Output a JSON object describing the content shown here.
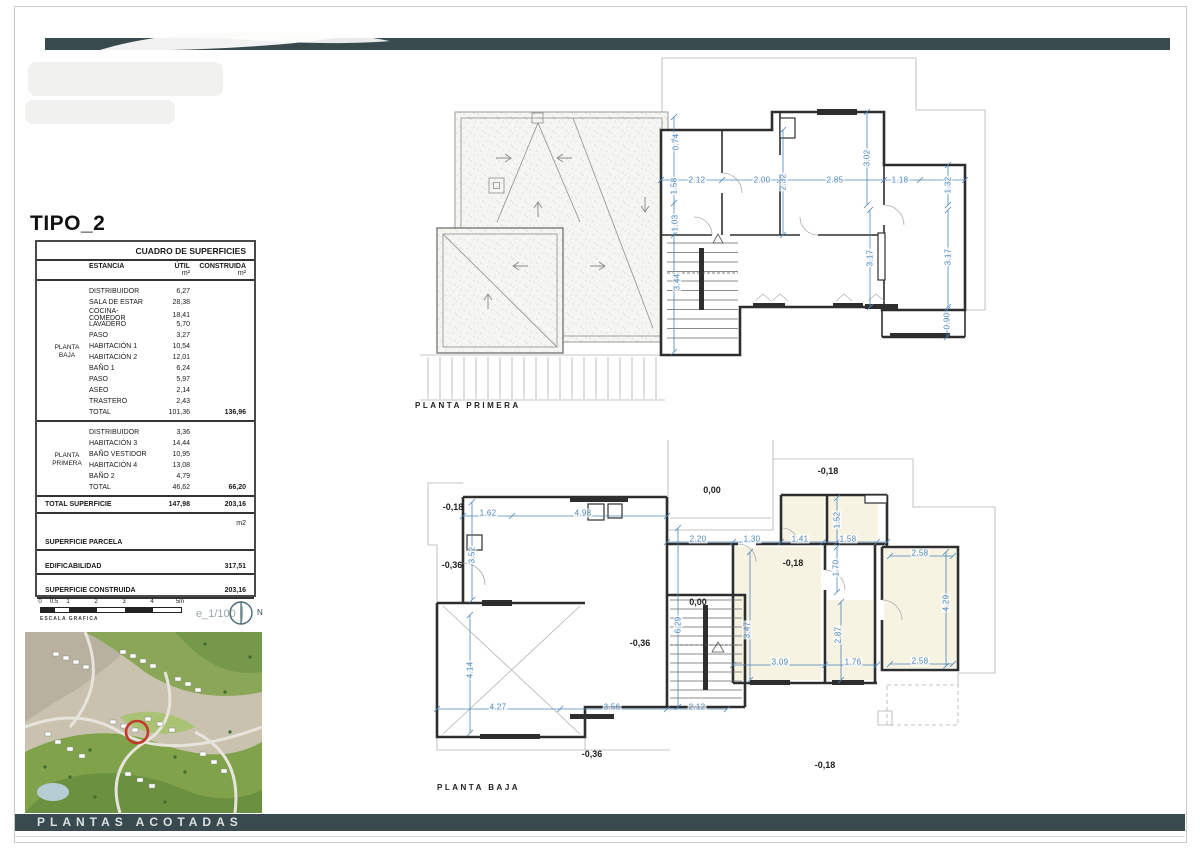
{
  "sheet": {
    "title": "TIPO_2"
  },
  "footer": {
    "label": "PLANTAS ACOTADAS"
  },
  "colors": {
    "accent_teal": "#394a4e",
    "dim_blue": "#4d86bb",
    "marker_red": "#c23b2a",
    "wall": "#2e2e2e"
  },
  "surfaces_table": {
    "title": "CUADRO DE SUPERFICIES",
    "headers": {
      "estancia": "ESTANCIA",
      "util": "ÚTIL",
      "construida": "CONSTRUIDA",
      "unit": "m²"
    },
    "groups": [
      {
        "name_lines": [
          "PLANTA",
          "BAJA"
        ],
        "rows": [
          {
            "estancia": "DISTRIBUIDOR",
            "util": "6,27",
            "construida": ""
          },
          {
            "estancia": "SALA DE ESTAR",
            "util": "28,38",
            "construida": ""
          },
          {
            "estancia": "COCINA-COMEDOR",
            "util": "18,41",
            "construida": ""
          },
          {
            "estancia": "LAVADERO",
            "util": "5,70",
            "construida": ""
          },
          {
            "estancia": "PASO",
            "util": "3,27",
            "construida": ""
          },
          {
            "estancia": "HABITACIÓN 1",
            "util": "10,54",
            "construida": ""
          },
          {
            "estancia": "HABITACIÓN 2",
            "util": "12,01",
            "construida": ""
          },
          {
            "estancia": "BAÑO 1",
            "util": "6,24",
            "construida": ""
          },
          {
            "estancia": "PASO",
            "util": "5,97",
            "construida": ""
          },
          {
            "estancia": "ASEO",
            "util": "2,14",
            "construida": ""
          },
          {
            "estancia": "TRASTERO",
            "util": "2,43",
            "construida": ""
          }
        ],
        "total": {
          "estancia": "TOTAL",
          "util": "101,36",
          "construida": "136,96"
        }
      },
      {
        "name_lines": [
          "PLANTA",
          "PRIMERA"
        ],
        "rows": [
          {
            "estancia": "DISTRIBUIDOR",
            "util": "3,36",
            "construida": ""
          },
          {
            "estancia": "HABITACIÓN 3",
            "util": "14,44",
            "construida": ""
          },
          {
            "estancia": "BAÑO VESTIDOR",
            "util": "10,95",
            "construida": ""
          },
          {
            "estancia": "HABITACIÓN 4",
            "util": "13,08",
            "construida": ""
          },
          {
            "estancia": "BAÑO 2",
            "util": "4,79",
            "construida": ""
          }
        ],
        "total": {
          "estancia": "TOTAL",
          "util": "46,62",
          "construida": "66,20"
        }
      }
    ],
    "total_row": {
      "label": "TOTAL SUPERFICIE",
      "util": "147,98",
      "construida": "203,16"
    },
    "m2_note": "m2",
    "footer_rows": [
      {
        "label": "SUPERFICIE PARCELA",
        "value": ""
      },
      {
        "label": "EDIFICABILIDAD",
        "value": "317,51"
      },
      {
        "label": "SUPERFICIE CONSTRUIDA",
        "value": "203,16"
      }
    ]
  },
  "scale_bar": {
    "labels": [
      "0",
      "0.5",
      "1",
      "2",
      "3",
      "4",
      "5m"
    ],
    "caption": "ESCALA GRAFICA",
    "ratio": "e_1/100",
    "compass_label": "N"
  },
  "plans": {
    "primera": {
      "label": "PLANTA PRIMERA",
      "dims": [
        {
          "t": "0.74",
          "x": 256,
          "y": 87,
          "r": -90
        },
        {
          "t": "1.58",
          "x": 254,
          "y": 131,
          "r": -90
        },
        {
          "t": "1.03",
          "x": 255,
          "y": 168,
          "r": -90
        },
        {
          "t": "3.44",
          "x": 257,
          "y": 227,
          "r": -90
        },
        {
          "t": "2.12",
          "x": 277,
          "y": 125,
          "r": 0
        },
        {
          "t": "2.00",
          "x": 342,
          "y": 125,
          "r": 0
        },
        {
          "t": "2.32",
          "x": 363,
          "y": 127,
          "r": -90
        },
        {
          "t": "2.85",
          "x": 415,
          "y": 125,
          "r": 0
        },
        {
          "t": "3.02",
          "x": 447,
          "y": 103,
          "r": -90
        },
        {
          "t": "1.18",
          "x": 480,
          "y": 125,
          "r": 0
        },
        {
          "t": "1.32",
          "x": 528,
          "y": 130,
          "r": -90
        },
        {
          "t": "3.17",
          "x": 450,
          "y": 203,
          "r": -90
        },
        {
          "t": "3.17",
          "x": 528,
          "y": 202,
          "r": -90
        },
        {
          "t": "0.90",
          "x": 527,
          "y": 266,
          "r": -90
        }
      ],
      "levels": []
    },
    "baja": {
      "label": "PLANTA BAJA",
      "dims": [
        {
          "t": "1.62",
          "x": 68,
          "y": 73,
          "r": 0
        },
        {
          "t": "4.98",
          "x": 163,
          "y": 73,
          "r": 0
        },
        {
          "t": "3.52",
          "x": 52,
          "y": 115,
          "r": -90
        },
        {
          "t": "2.20",
          "x": 278,
          "y": 99,
          "r": 0
        },
        {
          "t": "1.30",
          "x": 332,
          "y": 99,
          "r": 0
        },
        {
          "t": "1.41",
          "x": 380,
          "y": 99,
          "r": 0
        },
        {
          "t": "1.58",
          "x": 428,
          "y": 99,
          "r": 0
        },
        {
          "t": "1.52",
          "x": 417,
          "y": 80,
          "r": -90
        },
        {
          "t": "1.70",
          "x": 416,
          "y": 128,
          "r": -90
        },
        {
          "t": "2.58",
          "x": 500,
          "y": 113,
          "r": 0
        },
        {
          "t": "4.29",
          "x": 526,
          "y": 163,
          "r": -90
        },
        {
          "t": "2.58",
          "x": 500,
          "y": 221,
          "r": 0
        },
        {
          "t": "3.47",
          "x": 327,
          "y": 190,
          "r": -90
        },
        {
          "t": "2.87",
          "x": 418,
          "y": 195,
          "r": -90
        },
        {
          "t": "3.09",
          "x": 360,
          "y": 222,
          "r": 0
        },
        {
          "t": "1.76",
          "x": 433,
          "y": 222,
          "r": 0
        },
        {
          "t": "6.29",
          "x": 258,
          "y": 185,
          "r": -90
        },
        {
          "t": "4.14",
          "x": 50,
          "y": 230,
          "r": -90
        },
        {
          "t": "4.27",
          "x": 78,
          "y": 267,
          "r": 0
        },
        {
          "t": "3.56",
          "x": 192,
          "y": 267,
          "r": 0
        },
        {
          "t": "2.12",
          "x": 277,
          "y": 267,
          "r": 0
        }
      ],
      "levels": [
        {
          "t": "-0,18",
          "x": 33,
          "y": 67
        },
        {
          "t": "-0,36",
          "x": 32,
          "y": 125
        },
        {
          "t": "0,00",
          "x": 292,
          "y": 50
        },
        {
          "t": "-0,18",
          "x": 408,
          "y": 31
        },
        {
          "t": "-0,18",
          "x": 373,
          "y": 123
        },
        {
          "t": "0,00",
          "x": 278,
          "y": 162
        },
        {
          "t": "-0,36",
          "x": 220,
          "y": 203
        },
        {
          "t": "-0,36",
          "x": 172,
          "y": 314
        },
        {
          "t": "-0,18",
          "x": 405,
          "y": 325
        }
      ]
    }
  }
}
